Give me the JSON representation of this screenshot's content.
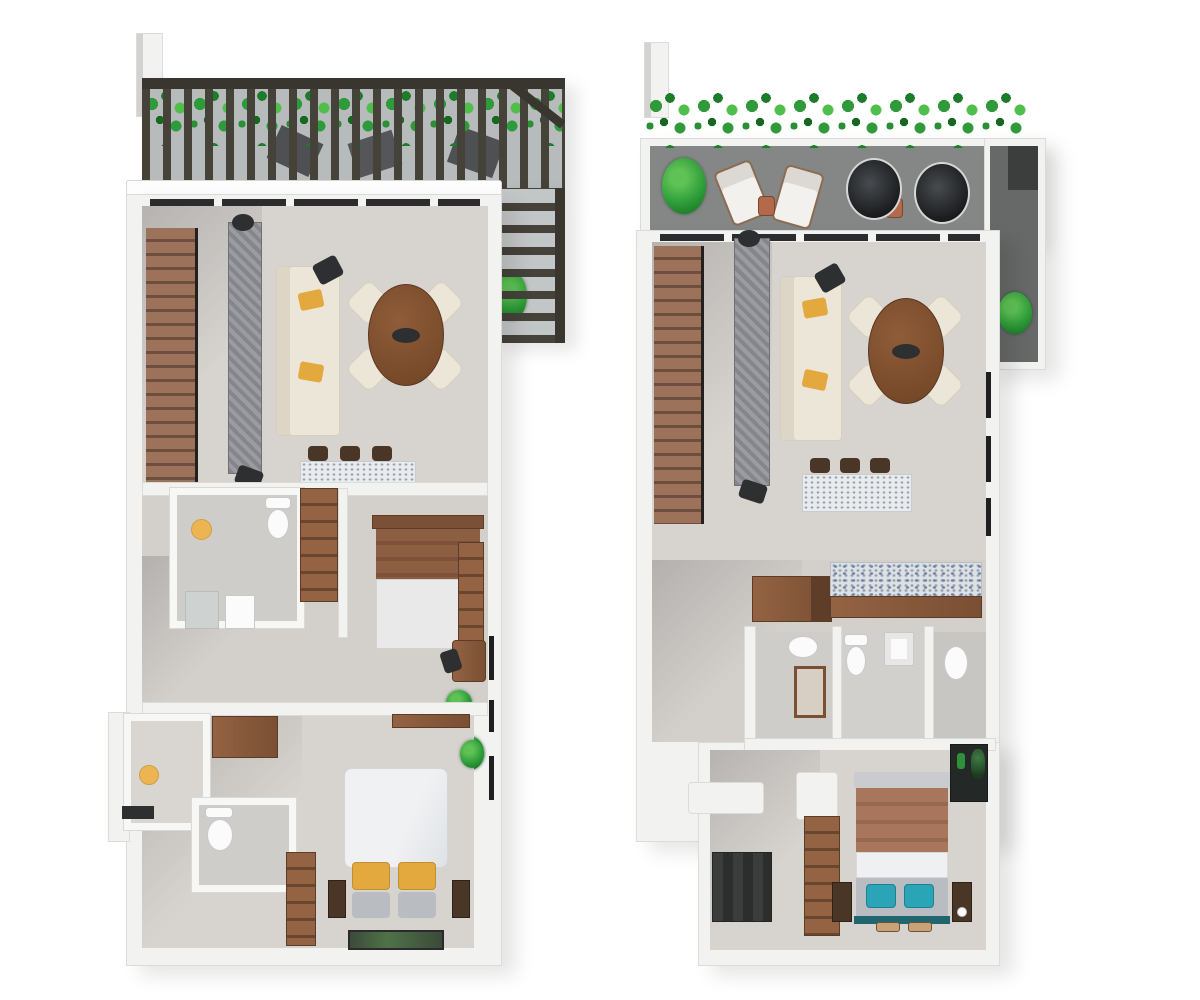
{
  "meta": {
    "description": "3D top-down architectural rendering of two apartment floor plans side by side on a white background; no text labels are visible in the image.",
    "plans": [
      {
        "id": "plan-a",
        "label": "left floor plan",
        "features": [
          "pergola roof deck with greenery",
          "wood staircase",
          "living room with sofa and TV console",
          "round dining table with four chairs",
          "kitchen island with three stools",
          "bathroom with toilet and round sink",
          "wardrobe closet",
          "bedroom with wood-frame bed and shelf",
          "desk with chair and plants",
          "utility room",
          "second bathroom",
          "master bedroom with yellow-pillow bed and bench"
        ]
      },
      {
        "id": "plan-b",
        "label": "right floor plan",
        "features": [
          "terrace with green hedge, two loungers and two papasan chairs",
          "side terrace with plant",
          "wood staircase",
          "living room with sofa and TV console",
          "round dining table with four chairs",
          "kitchen island with three stools",
          "L-shaped wood kitchen counter",
          "two bathrooms and shower room",
          "bedroom with teal-pillow bed, wardrobe and closet"
        ]
      }
    ]
  },
  "colors": {
    "bg": "#ffffff",
    "wall": "#f2f2f1",
    "wallEdge": "#dbdbd9",
    "floor": "#d7d4d0",
    "floorB": "#d3d0cc",
    "rug": "#cac8c5",
    "terrace": "#848786",
    "terraceDark": "#666968",
    "pergola": "#45423a",
    "rail": "#38362f",
    "stair1": "#9c735a",
    "stair2": "#6e4e3c",
    "wood1": "#936343",
    "wood2": "#7a4f33",
    "cream": "#ece6d8",
    "creamEdge": "#d6cfbe",
    "yellow": "#e3a93f",
    "tableWood": "#8f5c38",
    "tableEdge": "#6f4426",
    "teal": "#2ba4b6",
    "copper": "#b26a4a",
    "dark": "#2e2f31",
    "porcelain": "#fbfbfb",
    "mosaic": "#e9ecef",
    "grayFurn": "#8e8f94"
  }
}
